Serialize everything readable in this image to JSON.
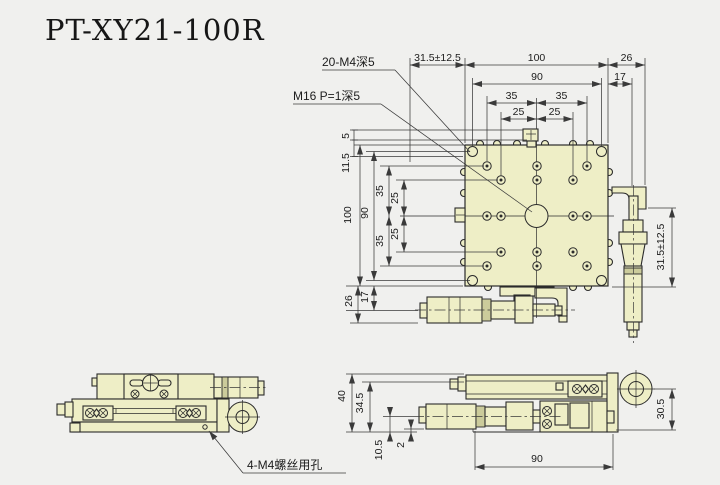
{
  "title": "PT-XY21-100R",
  "colors": {
    "background": "#f0f0ee",
    "part_fill": "#eeeec6",
    "part_fill_dark": "#cbcb9b",
    "line": "#2b2b2b",
    "dim_line": "#3a3a3a",
    "text": "#1c1c1c"
  },
  "plan": {
    "callout_m4": "20-M4深5",
    "callout_m16": "M16 P=1深5",
    "dim_travel_top": "31.5±12.5",
    "dim_width": "100",
    "dim_right_offset": "26",
    "dim_hole_span": "90",
    "dim_right_inner": "17",
    "dim_35_left": "35",
    "dim_35_right": "35",
    "dim_25_left": "25",
    "dim_25_right": "25",
    "dim_block_step": "5",
    "dim_edge_offset": "11.5",
    "dim_height": "100",
    "dim_hole_span_v": "90",
    "dim_35_top": "35",
    "dim_25_top": "25",
    "dim_25_bottom": "25",
    "dim_35_bottom": "35",
    "dim_bottom_offset": "26",
    "dim_bottom_inner": "17",
    "dim_travel_right": "31.5±12.5"
  },
  "front": {
    "callout_screw_holes": "4-M4螺丝用孔"
  },
  "side": {
    "dim_height": "40",
    "dim_height_inner": "34.5",
    "dim_axis_height": "10.5",
    "dim_base_gap": "2",
    "dim_body_width": "90",
    "dim_ring_height": "30.5"
  }
}
